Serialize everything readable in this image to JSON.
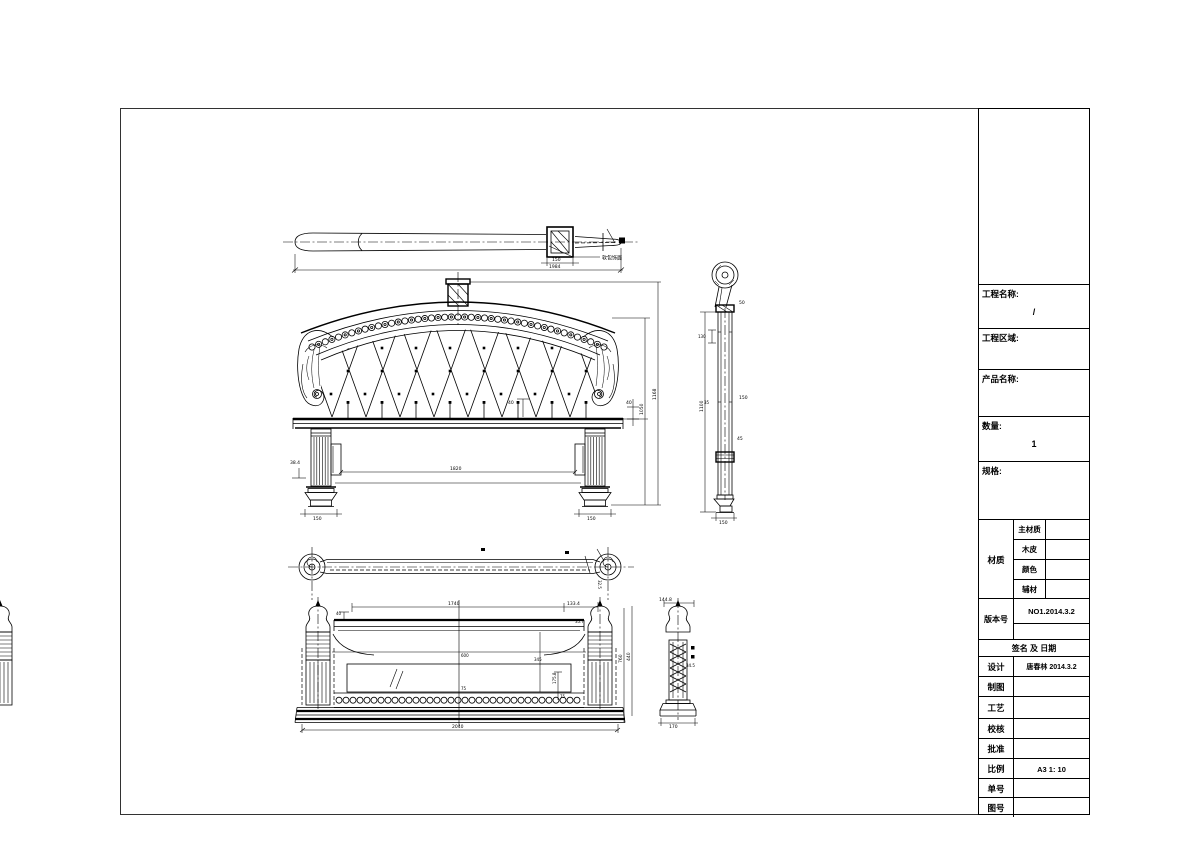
{
  "sheet": {
    "background": "#ffffff",
    "line_color": "#000000"
  },
  "title_block": {
    "project_name_label": "工程名称:",
    "project_name_value": "/",
    "project_area_label": "工程区域:",
    "product_name_label": "产品名称:",
    "quantity_label": "数量:",
    "quantity_value": "1",
    "spec_label": "规格:",
    "material_label": "材质",
    "material_rows": [
      {
        "label": "主材质",
        "value": ""
      },
      {
        "label": "木皮",
        "value": ""
      },
      {
        "label": "颜色",
        "value": ""
      },
      {
        "label": "辅材",
        "value": ""
      }
    ],
    "version_label": "版本号",
    "version_value": "NO1.2014.3.2",
    "signature_header": "签名 及 日期",
    "sign_rows": [
      {
        "label": "设计",
        "value": "唐春林 2014.3.2"
      },
      {
        "label": "制图",
        "value": ""
      },
      {
        "label": "工艺",
        "value": ""
      },
      {
        "label": "校核",
        "value": ""
      },
      {
        "label": "批准",
        "value": ""
      },
      {
        "label": "比例",
        "value": "A3 1: 10"
      },
      {
        "label": "单号",
        "value": ""
      },
      {
        "label": "图号",
        "value": ""
      }
    ]
  },
  "views": {
    "headboard_plan": {
      "note": "软包饰面",
      "dim_block": "150",
      "dim_overall": "1984"
    },
    "headboard_front": {
      "dim_tuft": "40",
      "dim_span": "1820",
      "dim_left_offset": "38.4",
      "dim_rail": "40",
      "dim_scroll_height": "1050",
      "dim_total_height": "1168",
      "dim_foot": "150"
    },
    "headboard_side": {
      "dim_height": "1100",
      "dim_inner": "130",
      "dim_cap": "50",
      "dim_mid": "150",
      "dim_low": "45",
      "dim_small": "35",
      "dim_width": "150"
    },
    "footboard_plan": {
      "dim_offset": "32.5"
    },
    "footboard_front": {
      "dim_rail_span": "1740",
      "dim_rail_end": "133.4",
      "dim_a": "40",
      "dim_b": "35.7",
      "dim_panel_h": "345",
      "dim_c": "175.8",
      "dim_d": "75",
      "dim_center_a": "600",
      "dim_center_b": "75",
      "dim_height": "760",
      "dim_overall": "2040"
    },
    "footboard_side": {
      "dim_top": "144.8",
      "dim_h": "440",
      "dim_side": "34.5",
      "dim_w": "170"
    }
  }
}
